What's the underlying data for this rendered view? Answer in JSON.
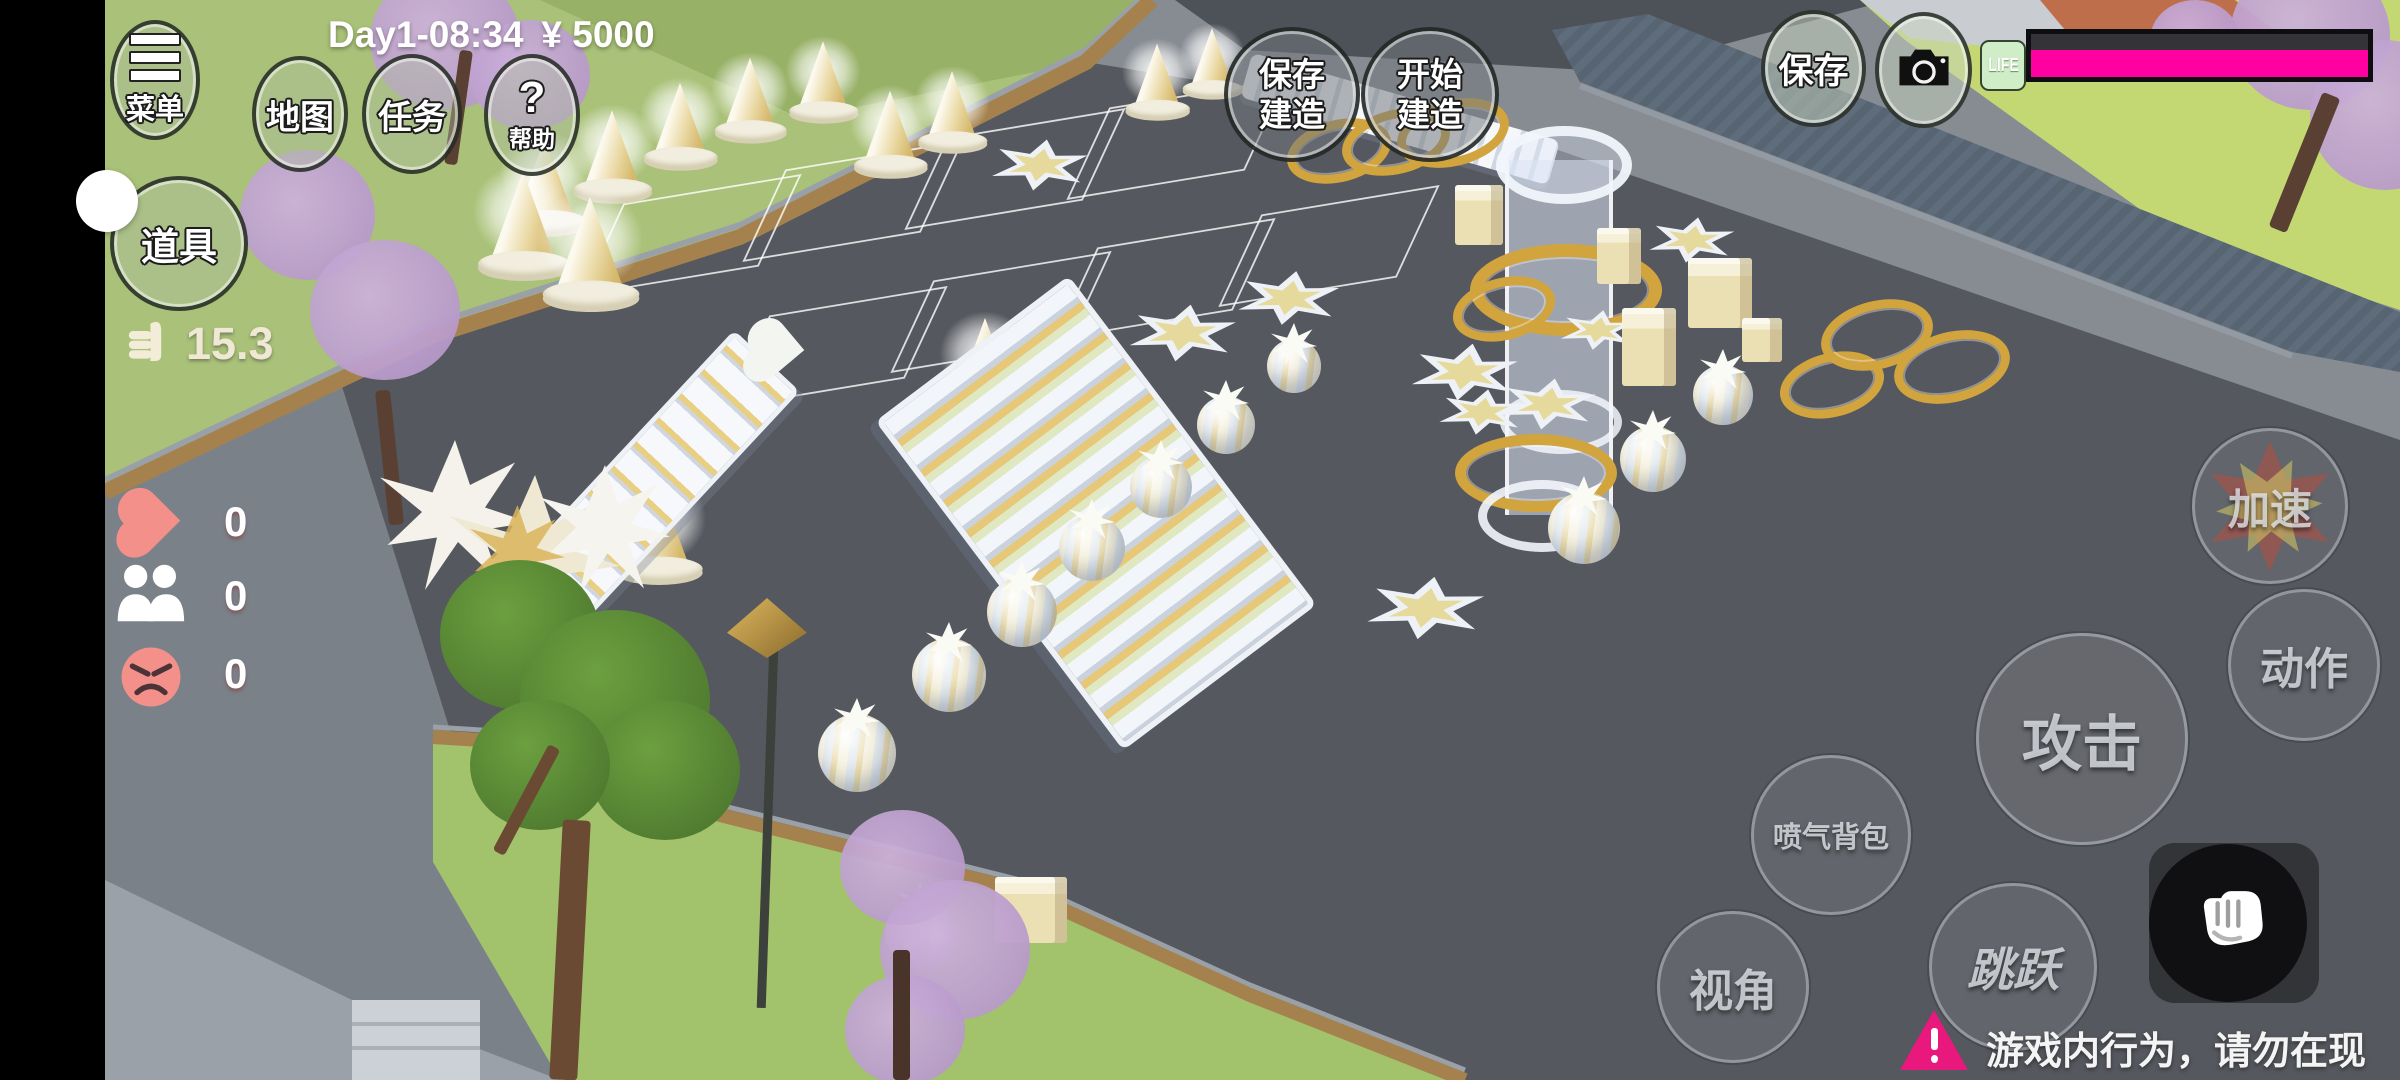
{
  "status_bar": {
    "day_time": "Day1-08:34",
    "money": "¥ 5000"
  },
  "top_left": {
    "menu": "菜单",
    "map": "地图",
    "task": "任务",
    "help_mark": "?",
    "help": "帮助",
    "props": "道具"
  },
  "build": {
    "save_build": "保存建造",
    "start_build": "开始建造"
  },
  "top_right": {
    "save": "保存",
    "life_label": "LIFE",
    "life_value_pct": 100
  },
  "meters": {
    "speed": "15.3",
    "love": "0",
    "people": "0",
    "anger": "0"
  },
  "controls": {
    "boost": "加速",
    "action": "动作",
    "attack": "攻击",
    "jetpack": "喷气背包",
    "view": "视角",
    "jump": "跳跃"
  },
  "warning": {
    "text": "游戏内行为，请勿在现实中模仿"
  },
  "colors": {
    "life_bar": "#ff01a0",
    "warning_icon": "#e8187c",
    "heart": "#f4908a",
    "angry_face": "#f4908a",
    "grass_top_left": "#a9c178",
    "grass_top_right": "#c3d873",
    "asphalt": "#55585e",
    "gold": "#d2a43e"
  }
}
